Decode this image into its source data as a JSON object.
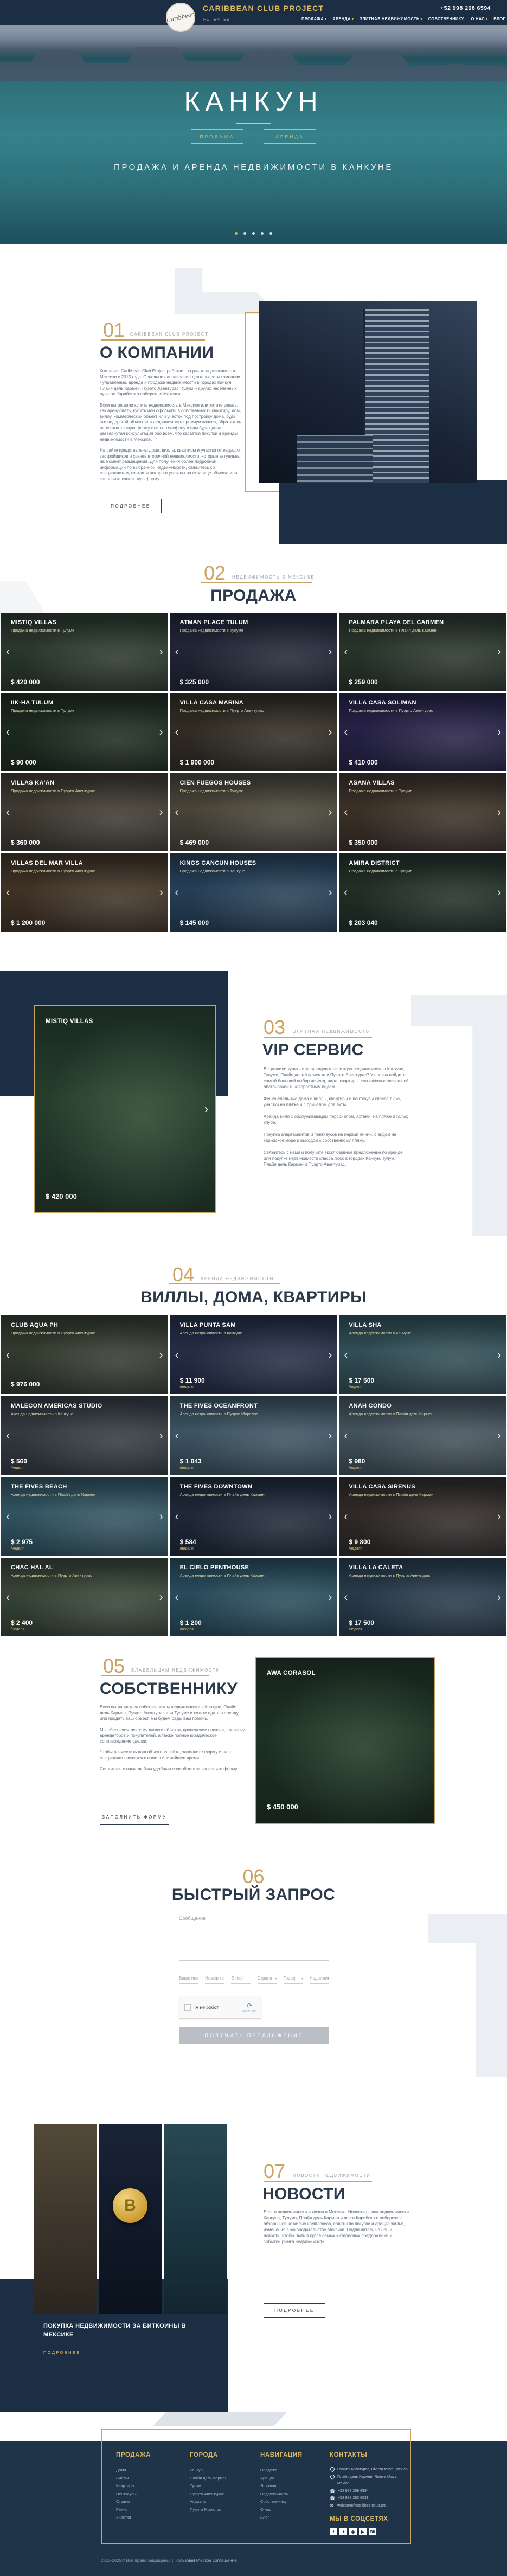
{
  "theme": {
    "gold": "#c9a35f",
    "navy": "#1c2e44"
  },
  "header": {
    "brand": "CARIBBEAN CLUB PROJECT",
    "logo_text": "Caribbean",
    "phone": "+52 998 268 6594",
    "languages": [
      "RU",
      "EN",
      "ES"
    ],
    "nav": [
      {
        "label": "ПРОДАЖА",
        "caret": "▾"
      },
      {
        "label": "АРЕНДА",
        "caret": "▾"
      },
      {
        "label": "ЭЛИТНАЯ НЕДВИЖИМОСТЬ",
        "caret": "▾"
      },
      {
        "label": "СОБСТВЕННИКУ",
        "caret": ""
      },
      {
        "label": "О НАС",
        "caret": "▾"
      },
      {
        "label": "БЛОГ",
        "caret": ""
      }
    ]
  },
  "hero": {
    "title": "КАНКУН",
    "button_sale": "ПРОДАЖА",
    "button_rent": "АРЕНДА",
    "subtitle": "ПРОДАЖА И АРЕНДА НЕДВИЖИМОСТИ В КАНКУНЕ",
    "dots": [
      {
        "state": "active"
      },
      {
        "state": "inactive"
      },
      {
        "state": "inactive"
      },
      {
        "state": "inactive"
      },
      {
        "state": "inactive"
      }
    ]
  },
  "about": {
    "number": "01",
    "tagline": "CARIBBEAN CLUB PROJECT",
    "heading": "О КОМПАНИИ",
    "paragraphs": [
      "Компания Caribbean Club Project работает на рынке недвижимости Мексики с 2015 года. Основное направление деятельности компании - управление, аренда и продажа недвижимости в городах Канкун, Плайя дель Кармен, Пуэрто Авентурас, Тулум и других населенных пунктах Карибского побережья Мексики.",
      "Если вы решили купить недвижимость в Мексике или хотите узнать, как арендовать, купить или оформить в собственность квартиру, дом, виллу, коммерческий объект или участок под постройку дома, будь это недорогой объект или недвижимость премиум класса, обратитесь через контактную форму или по телефону и вам будет дана развернутая консультация обо всем, что касается покупки и аренды недвижимости в Мексике.",
      "На сайте представлены дома, виллы, квартиры и участки от ведущих застройщиков и хозяев вторичной недвижимости, которые актуальны на момент размещения. Для получения более подробной информации по выбранной недвижимости, свяжитесь со специалистом, контакты которого указаны на странице объекта или заполните контактную форму"
    ],
    "button": "ПОДРОБНЕЕ"
  },
  "sale": {
    "number": "02",
    "tagline": "НЕДВИЖИМОСТЬ В МЕКСИКЕ",
    "heading": "ПРОДАЖА",
    "cards": [
      {
        "title": "MISTIQ VILLAS",
        "location": "Продажа недвижимости в Тулуме",
        "price": "$ 420 000",
        "tint": "#31402e"
      },
      {
        "title": "ATMAN PLACE TULUM",
        "location": "Продажа недвижимости в Тулуме",
        "price": "$ 325 000",
        "tint": "#262a3c"
      },
      {
        "title": "PALMARA PLAYA DEL CARMEN",
        "location": "Продажа недвижимости в Плайя дель Кармен",
        "price": "$ 259 000",
        "tint": "#2f3d2e"
      },
      {
        "title": "IIK-HA TULUM",
        "location": "Продажа недвижимости в Тулуме",
        "price": "$ 90 000",
        "tint": "#20301f"
      },
      {
        "title": "VILLA CASA MARINA",
        "location": "Продажа недвижимости в Пуэрто Авентурас",
        "price": "$ 1 900 000",
        "tint": "#3a3226"
      },
      {
        "title": "VILLA CASA SOLIMAN",
        "location": "Продажа недвижимости в Пуэрто Авентурас",
        "price": "$ 410 000",
        "tint": "#2c2550"
      },
      {
        "title": "VILLAS KA'AN",
        "location": "Продажа недвижимости в Пуэрто Авентурас",
        "price": "$ 360 000",
        "tint": "#4a4336"
      },
      {
        "title": "CIEN FUEGOS HOUSES",
        "location": "Продажа недвижимости в Тулуме",
        "price": "$ 469 000",
        "tint": "#56503f"
      },
      {
        "title": "ASANA VILLAS",
        "location": "Продажа недвижимости в Тулуме",
        "price": "$ 350 000",
        "tint": "#463829"
      },
      {
        "title": "VILLAS DEL MAR VILLA",
        "location": "Продажа недвижимости в Пуэрто Авентурас",
        "price": "$ 1 200 000",
        "tint": "#4c3a28"
      },
      {
        "title": "KINGS CANCUN HOUSES",
        "location": "Продажа недвижимости в Канкуне",
        "price": "$ 145 000",
        "tint": "#2c4a66"
      },
      {
        "title": "AMIRA DISTRICT",
        "location": "Продажа недвижимости в Тулуме",
        "price": "$ 203 040",
        "tint": "#263629"
      }
    ]
  },
  "vip": {
    "number": "03",
    "tagline": "ЭЛИТНАЯ НЕДВИЖИМОСТЬ",
    "heading": "VIP СЕРВИС",
    "paragraphs": [
      "Вы решили купить или арендовать элитную недвижимость в Канкуне, Тулуме, Плайя дель Кармен или Пуэрто Авентурас? У нас вы найдете самый большой выбор асьенд, вилл, квартир - пентхаусов с роскошной обстановкой и невероятным видом.",
      "Фешенебельные дома и виллы, квартиры и пентхаусы класса люкс, участки на пляже и с причалом для яхты.",
      "Аренда вилл с обслуживающим персоналом, яхтами, на пляже и гольф клубе.",
      "Покупка апартаментов и пентхаусов на первой линии, с видом на карибское море и выходом к собственному пляжу.",
      "Свяжитесь с нами и получите эксклюзивное предложение по аренде или покупке недвижимости класса люкс в городах Канкун, Тулум, Плайя дель Кармен и Пуэрто Авентурас."
    ],
    "card": {
      "title": "MISTIQ VILLAS",
      "price": "$ 420 000",
      "tint": "#2b4630"
    }
  },
  "rent": {
    "number": "04",
    "tagline": "АРЕНДА НЕДВИЖИМОСТИ",
    "heading": "ВИЛЛЫ, ДОМА, КВАРТИРЫ",
    "cards": [
      {
        "title": "CLUB AQUA PH",
        "location": "Продажа недвижимости в Пуэрто Авентурас",
        "price": "$ 976 000",
        "period": "",
        "tint": "#3c4433"
      },
      {
        "title": "VILLA PUNTA SAM",
        "location": "Аренда недвижимости в Канкуне",
        "price": "$ 11 900",
        "period": "/неделя",
        "tint": "#2a3450"
      },
      {
        "title": "VILLA SHA",
        "location": "Аренда недвижимости в Канкуне",
        "price": "$ 17 500",
        "period": "/неделя",
        "tint": "#3a5c64"
      },
      {
        "title": "MALECON AMERICAS STUDIO",
        "location": "Аренда недвижимости в Канкуне",
        "price": "$ 560",
        "period": "/неделя",
        "tint": "#3c4348"
      },
      {
        "title": "THE FIVES OCEANFRONT",
        "location": "Аренда недвижимости в Пуэрто Морелос",
        "price": "$ 1 043",
        "period": "/неделя",
        "tint": "#486373"
      },
      {
        "title": "ANAH CONDO",
        "location": "Аренда недвижимости в Плайя дель Кармен",
        "price": "$ 980",
        "period": "/неделя",
        "tint": "#50616b"
      },
      {
        "title": "THE FIVES BEACH",
        "location": "Аренда недвижимости в Плайя дель Кармен",
        "price": "$ 2 975",
        "period": "/неделя",
        "tint": "#3a6472"
      },
      {
        "title": "THE FIVES DOWNTOWN",
        "location": "Аренда недвижимости в Плайя дель Кармен",
        "price": "$ 584",
        "period": "/неделя",
        "tint": "#232e40"
      },
      {
        "title": "VILLA CASA SIRENUS",
        "location": "Аренда недвижимости в Плайя дель Кармен",
        "price": "$ 9 800",
        "period": "/неделя",
        "tint": "#38302a"
      },
      {
        "title": "CHAC HAL AL",
        "location": "Аренда недвижимости в Пуэрто Авентурас",
        "price": "$ 2 400",
        "period": "/неделя",
        "tint": "#41503c"
      },
      {
        "title": "EL CIELO PENTHOUSE",
        "location": "Аренда недвижимости в Плайя дель Кармен",
        "price": "$ 1 200",
        "period": "/неделя",
        "tint": "#2f5a6c"
      },
      {
        "title": "VILLA LA CALETA",
        "location": "Аренда недвижимости в Пуэрто Авентурас",
        "price": "$ 17 500",
        "period": "/неделя",
        "tint": "#2e4456"
      }
    ]
  },
  "owner": {
    "number": "05",
    "tagline": "ВЛАДЕЛЬЦАМ НЕДВИЖИМОСТИ",
    "heading": "СОБСТВЕННИКУ",
    "paragraphs": [
      "Если вы являетесь собственником недвижимости в Канкуне, Плайя дель Кармен, Пуэрто Авентурас или Тулуме и хотите сдать в аренду или продать ваш объект, мы будем рады вам помочь.",
      "Мы обеспечим рекламу вашего объекта, проведение показов, проверку арендаторов и покупателей, а также полное юридическое сопровождение сделки.",
      "Чтобы разместить ваш объект на сайте, заполните форму и наш специалист свяжется с вами в ближайшее время.",
      "Свяжитесь с нами любым удобным способом или заполните форму."
    ],
    "button": "ЗАПОЛНИТЬ ФОРМУ",
    "card": {
      "title": "AWA CORASOL",
      "price": "$ 450 000",
      "tint": "#223826"
    }
  },
  "request": {
    "number": "06",
    "heading": "БЫСТРЫЙ ЗАПРОС",
    "message_placeholder": "Сообщение",
    "fields": [
      {
        "placeholder": "Ваше имя",
        "caret": ""
      },
      {
        "placeholder": "Номер телефона",
        "caret": ""
      },
      {
        "placeholder": "E-mail",
        "caret": ""
      },
      {
        "placeholder": "Страна",
        "caret": "▾"
      },
      {
        "placeholder": "Город",
        "caret": "▾"
      },
      {
        "placeholder": "Недвижимость",
        "caret": "▾"
      }
    ],
    "captcha_label": "Я не робот",
    "captcha_brand": "reCAPTCHA",
    "submit": "ПОЛУЧИТЬ ПРЕДЛОЖЕНИЕ"
  },
  "news": {
    "number": "07",
    "tagline": "НОВОСТИ НЕДВИЖИМОСТИ",
    "heading": "НОВОСТИ",
    "paragraph": "Блог о недвижимости и жизни в Мексике. Новости рынка недвижимости Канкуна, Тулума, Плайя дель Кармен и всего Карибского побережья, обзоры новых жилых комплексов, советы по покупке и аренде жилья, изменения в законодательстве Мексики. Подпишитесь на наши новости, чтобы быть в курсе самых интересных предложений и событий рынка недвижимости.",
    "button": "ПОДРОБНЕЕ",
    "feature": {
      "title": "Покупка недвижимости за биткоины в Мексике",
      "link": "ПОДРОБНЕЕ",
      "bitcoin_symbol": "B"
    }
  },
  "footer": {
    "columns": [
      {
        "title": "ПРОДАЖА",
        "links": [
          "Дома",
          "Виллы",
          "Квартиры",
          "Пентхаусы",
          "Студии",
          "Ранчо",
          "Участки"
        ]
      },
      {
        "title": "ГОРОДА",
        "links": [
          "Канкун",
          "Плайя дель Кармен",
          "Тулум",
          "Пуэрто Авентурас",
          "Акумаль",
          "Пуэрто Морелос"
        ]
      },
      {
        "title": "НАВИГАЦИЯ",
        "links": [
          "Продажа",
          "Аренда",
          "Элитная",
          "Недвижимость",
          "Собственнику",
          "О нас",
          "Блог"
        ]
      }
    ],
    "contacts_title": "КОНТАКТЫ",
    "contacts": [
      {
        "icon": "pin",
        "text": "Пуэрто Авентурас, Riviera Maya, Mexico"
      },
      {
        "icon": "pin",
        "text": "Плайя дель Кармен, Riviera Maya, Mexico"
      },
      {
        "icon": "phone",
        "text": "+52 998 268 6594"
      },
      {
        "icon": "phone",
        "text": "+52 998 263 6031"
      },
      {
        "icon": "mail",
        "text": "welcome@caribbeanclub.pro"
      }
    ],
    "social_title": "МЫ В СОЦСЕТЯХ",
    "social": [
      {
        "name": "facebook",
        "glyph": "f"
      },
      {
        "name": "telegram",
        "glyph": "✈"
      },
      {
        "name": "instagram",
        "glyph": "◉"
      },
      {
        "name": "youtube",
        "glyph": "▶"
      },
      {
        "name": "vk",
        "glyph": "ВК"
      }
    ],
    "copyright": "2015-2025© Все права защищены. | ",
    "terms": "Пользовательское соглашение"
  }
}
